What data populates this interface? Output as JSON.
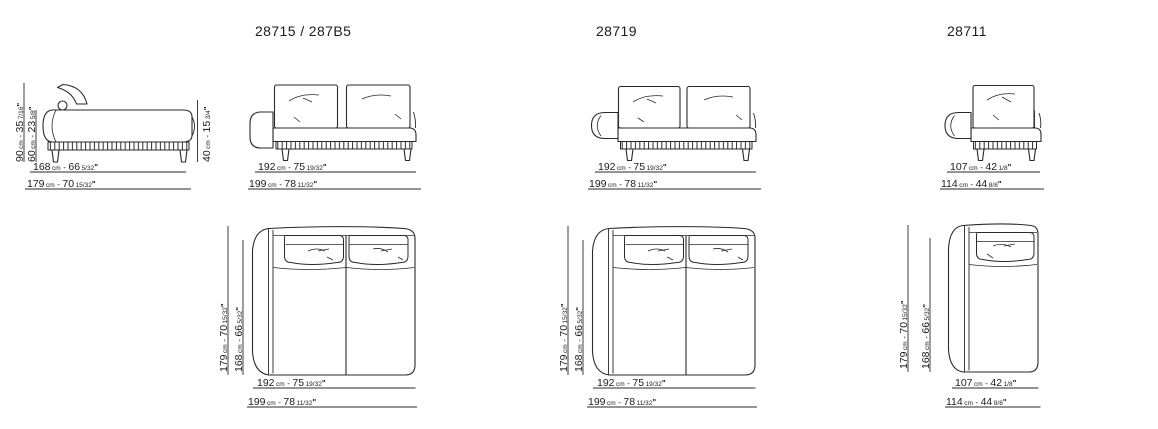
{
  "sheet": {
    "background": "#ffffff",
    "line_color": "#2a2a2a",
    "text_color": "#1d1d1d"
  },
  "titles": {
    "model1": "28715 / 287B5",
    "model2": "28719",
    "model3": "28711"
  },
  "format": {
    "cm_unit": "cm",
    "separator": "-",
    "inch_mark": "\""
  },
  "dims": {
    "d90": {
      "cm": "90",
      "inches": "35",
      "fraction": "7/16"
    },
    "d60": {
      "cm": "60",
      "inches": "23",
      "fraction": "5/8"
    },
    "d40": {
      "cm": "40",
      "inches": "15",
      "fraction": "3/4"
    },
    "d168": {
      "cm": "168",
      "inches": "66",
      "fraction": "5/32"
    },
    "d179": {
      "cm": "179",
      "inches": "70",
      "fraction": "15/32"
    },
    "d192": {
      "cm": "192",
      "inches": "75",
      "fraction": "19/32"
    },
    "d199": {
      "cm": "199",
      "inches": "78",
      "fraction": "11/32"
    },
    "d107": {
      "cm": "107",
      "inches": "42",
      "fraction": "1/8"
    },
    "d114": {
      "cm": "114",
      "inches": "44",
      "fraction": "8/8"
    }
  }
}
